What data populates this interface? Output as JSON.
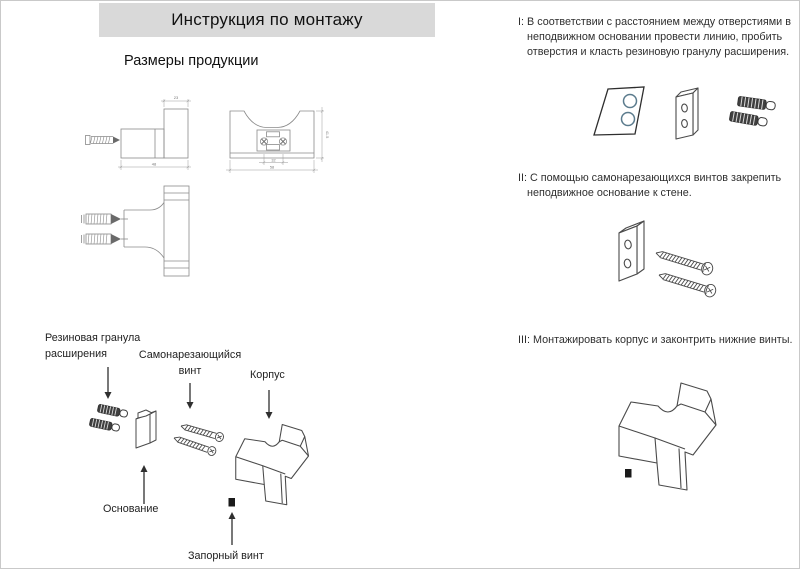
{
  "page": {
    "title": "Инструкция по монтажу",
    "subtitle": "Размеры продукции"
  },
  "steps": {
    "step1": "I: В соответствии с расстоянием между отверстиями в неподвижном основании провести линию, пробить отверстия и класть резиновую гранулу расширения.",
    "step2": "II: С помощью самонарезающихся винтов закрепить неподвижное основание к стене.",
    "step3": "III: Монтажировать корпус и законтрить нижние винты."
  },
  "part_labels": {
    "rubber_anchor": "Резиновая гранула\nрасширения",
    "self_tapping_screw": "Самонарезающийся\nвинт",
    "body": "Корпус",
    "base": "Основание",
    "lock_screw": "Запорный винт"
  },
  "dimensions": {
    "side_view_top_width": "23",
    "side_view_bottom_width": "48",
    "front_view_height": "41.5",
    "front_view_hole_spacing": "32",
    "front_view_width": "58"
  },
  "colors": {
    "title_bar_bg": "#d9d9d9",
    "heading_text": "#111111",
    "body_text": "#2f2f2f",
    "cad_line": "#8a8a8a",
    "sketch_line": "#4a4a4a",
    "hole_accent": "#5b7b8d",
    "dark_part": "#3f3f3f"
  }
}
